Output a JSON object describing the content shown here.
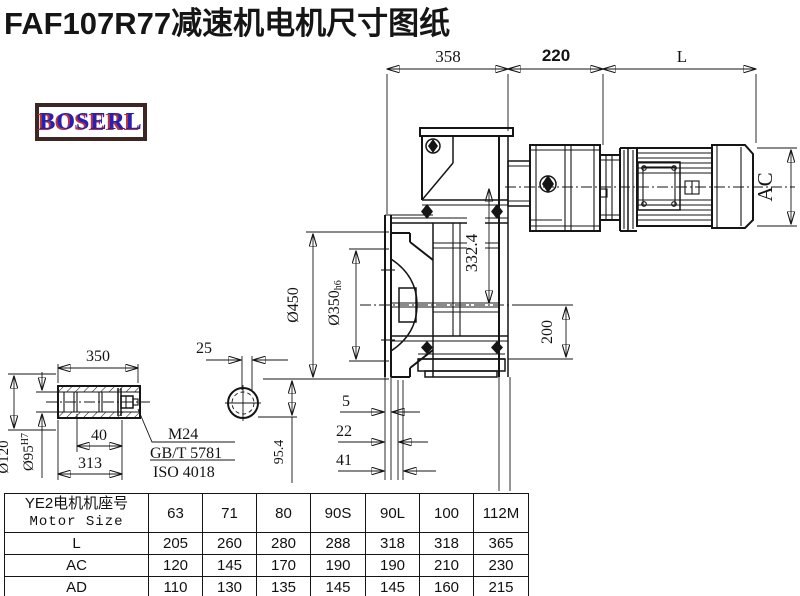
{
  "title": "FAF107R77减速机电机尺寸图纸",
  "logo": {
    "text": "BOSERL"
  },
  "dims": {
    "gearbox_width": "358",
    "adapter_width": "220",
    "motor_length": "L",
    "motor_diameter": "AC",
    "axis_distance": "332.4",
    "flange_diameter": "Ø450",
    "spigot_diameter": "Ø350",
    "spigot_tolerance": "h6",
    "base_height": "200",
    "offset_small": "5",
    "offset_mid": "22",
    "offset_large": "41",
    "shaft_length": "350",
    "key_width": "25",
    "hub_diameter": "Ø120",
    "bore_diameter": "Ø95",
    "bore_tolerance": "H7",
    "bolt_depth": "40",
    "insert_depth": "313",
    "center_height": "95.4"
  },
  "labels": {
    "bolt_spec": "M24",
    "bolt_standard_gb": "GB/T 5781",
    "bolt_standard_iso": "ISO 4018"
  },
  "table": {
    "header_cn": "YE2电机机座号",
    "header_en": "Motor Size",
    "columns": [
      "63",
      "71",
      "80",
      "90S",
      "90L",
      "100",
      "112M"
    ],
    "rows": [
      {
        "label": "L",
        "values": [
          "205",
          "260",
          "280",
          "288",
          "318",
          "318",
          "365"
        ]
      },
      {
        "label": "AC",
        "values": [
          "120",
          "145",
          "170",
          "190",
          "190",
          "210",
          "230"
        ]
      },
      {
        "label": "AD",
        "values": [
          "110",
          "130",
          "135",
          "145",
          "145",
          "160",
          "215"
        ]
      }
    ]
  }
}
